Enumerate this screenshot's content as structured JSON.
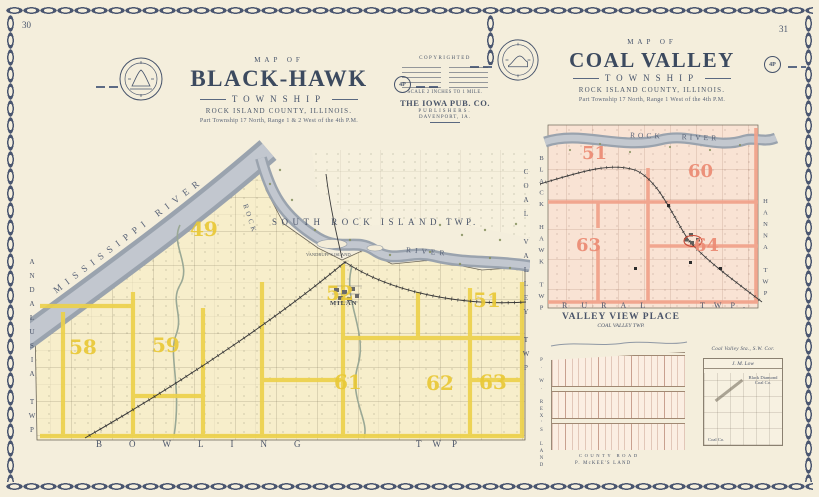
{
  "page": {
    "left_number": "30",
    "right_number": "31"
  },
  "bh": {
    "map_of": "MAP OF",
    "title": "BLACK-HAWK",
    "township": "TOWNSHIP",
    "county": "ROCK ISLAND COUNTY, ILLINOIS.",
    "range": "Part Township 17 North, Range 1 & 2 West of the 4th P.M.",
    "stamp": "4P",
    "neighbor_top": "SOUTH ROCK ISLAND",
    "neighbor_top_suffix": "TWP.",
    "neighbor_bottom": "BOWLING",
    "neighbor_bottom_suffix": "TWP",
    "neighbor_left": "ANDALUSIA TWP",
    "neighbor_right": "COAL VALLEY TWP",
    "river_mississippi": "MISSISSIPPI RIVER",
    "river_rock": "ROCK",
    "river_rock_2": "RIVER",
    "town_milan": "MILAN",
    "island": "VANDRUFF'S ISLAND",
    "sections": [
      "49",
      "51",
      "52",
      "58",
      "59",
      "61",
      "62",
      "63"
    ]
  },
  "cv": {
    "map_of": "MAP OF",
    "title": "COAL VALLEY",
    "township": "TOWNSHIP",
    "county": "ROCK ISLAND COUNTY, ILLINOIS.",
    "range": "Part Township 17 North, Range 1 West of the 4th P.M.",
    "stamp": "4P",
    "river": "ROCK RIVER",
    "neighbor_left": "BLACK HAWK TWP",
    "neighbor_bottom": "RURAL",
    "neighbor_bottom_suffix": "TWP.",
    "neighbor_right": "HANNA TWP",
    "sections": [
      "51",
      "60",
      "63",
      "64"
    ]
  },
  "publisher": {
    "copyrighted": "COPYRIGHTED",
    "scale": "SCALE 2 INCHES TO 1 MILE.",
    "name": "THE IOWA PUB. CO.",
    "role": "PUBLISHERS.",
    "city": "DAVENPORT, IA."
  },
  "valley_view": {
    "title": "VALLEY VIEW PLACE",
    "subtitle": "COAL VALLEY TWP.",
    "road": "COUNTY ROAD",
    "owner": "P. McKEE'S LAND",
    "side_owner": "P. W. REX'S LAND"
  },
  "station_inset": {
    "caption": "Coal Valley Sta., S.W. Cor.",
    "owner": "J. M. Low",
    "label_1": "Black Diamond Coal Co.",
    "label_2": "Coal Co."
  },
  "colors": {
    "ink": "#3e4b61",
    "section_yellow": "#e9c937",
    "section_red": "#ec8d76",
    "river_gray": "#aeb6c0",
    "road_yellow": "#ecd04b",
    "road_pink": "#f0a28b"
  }
}
